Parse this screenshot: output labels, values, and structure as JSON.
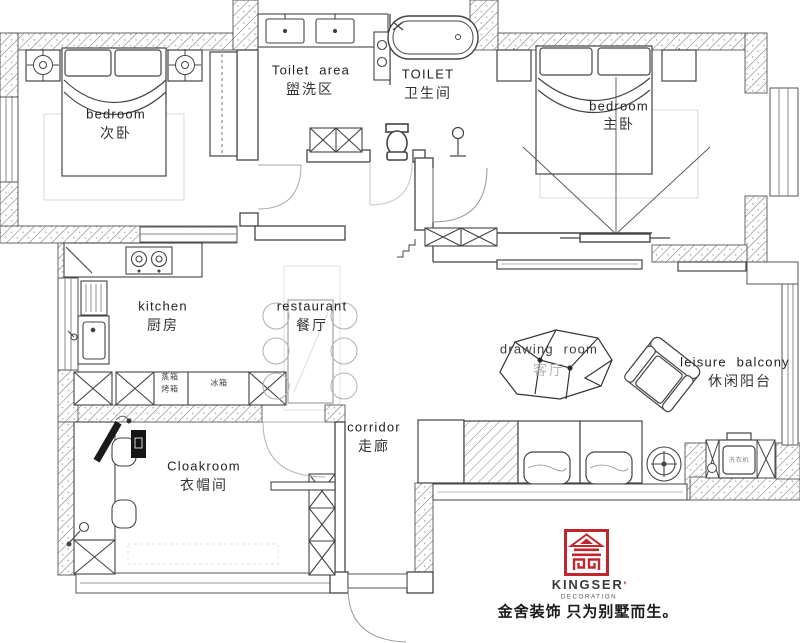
{
  "title": "apartment floor plan",
  "rooms": {
    "bedroom2": {
      "en": "bedroom",
      "zh": "次卧"
    },
    "toilet_area": {
      "en": "Toilet area",
      "zh": "盥洗区"
    },
    "toilet": {
      "en": "TOILET",
      "zh": "卫生间"
    },
    "bedroom1": {
      "en": "bedroom",
      "zh": "主卧"
    },
    "kitchen": {
      "en": "kitchen",
      "zh": "厨房"
    },
    "restaurant": {
      "en": "restaurant",
      "zh": "餐厅"
    },
    "drawing_room": {
      "en": "drawing room",
      "zh": "客厅"
    },
    "leisure_balcony": {
      "en": "leisure balcony",
      "zh": "休闲阳台"
    },
    "corridor": {
      "en": "corridor",
      "zh": "走廊"
    },
    "cloakroom": {
      "en": "Cloakroom",
      "zh": "衣帽间"
    }
  },
  "appliances": {
    "steam_box": "蒸箱",
    "oven": "烤箱",
    "fridge": "冰箱",
    "washing_machine": "洗衣机"
  },
  "brand": {
    "name": "KINGSER",
    "mark": "'",
    "division": "DECORATION",
    "slogan": "金舍装饰 只为别墅而生。",
    "accent_color": "#c0272d"
  }
}
